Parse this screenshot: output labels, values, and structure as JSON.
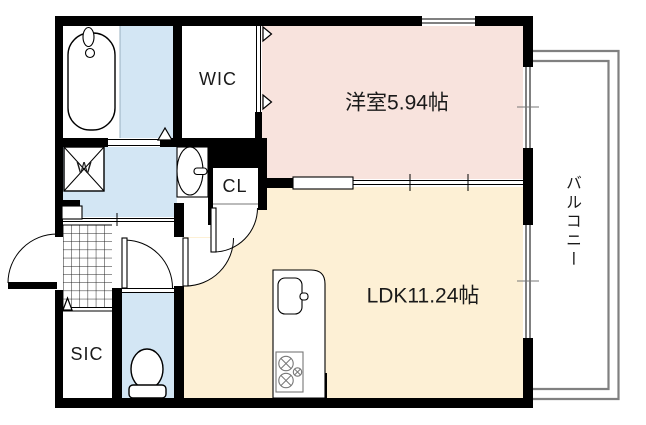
{
  "labels": {
    "western_room": "洋室5.94帖",
    "ldk": "LDK11.24帖",
    "wic": "WIC",
    "closet": "CL",
    "shoe_closet": "SIC",
    "washing_machine": "W",
    "balcony": "バルコニー"
  },
  "colors": {
    "room_pink": "#f8e3dd",
    "room_cream": "#fdf0d5",
    "room_blue": "#d3e6f4",
    "wall": "#000000",
    "balcony_line": "#808080",
    "background": "#ffffff"
  }
}
